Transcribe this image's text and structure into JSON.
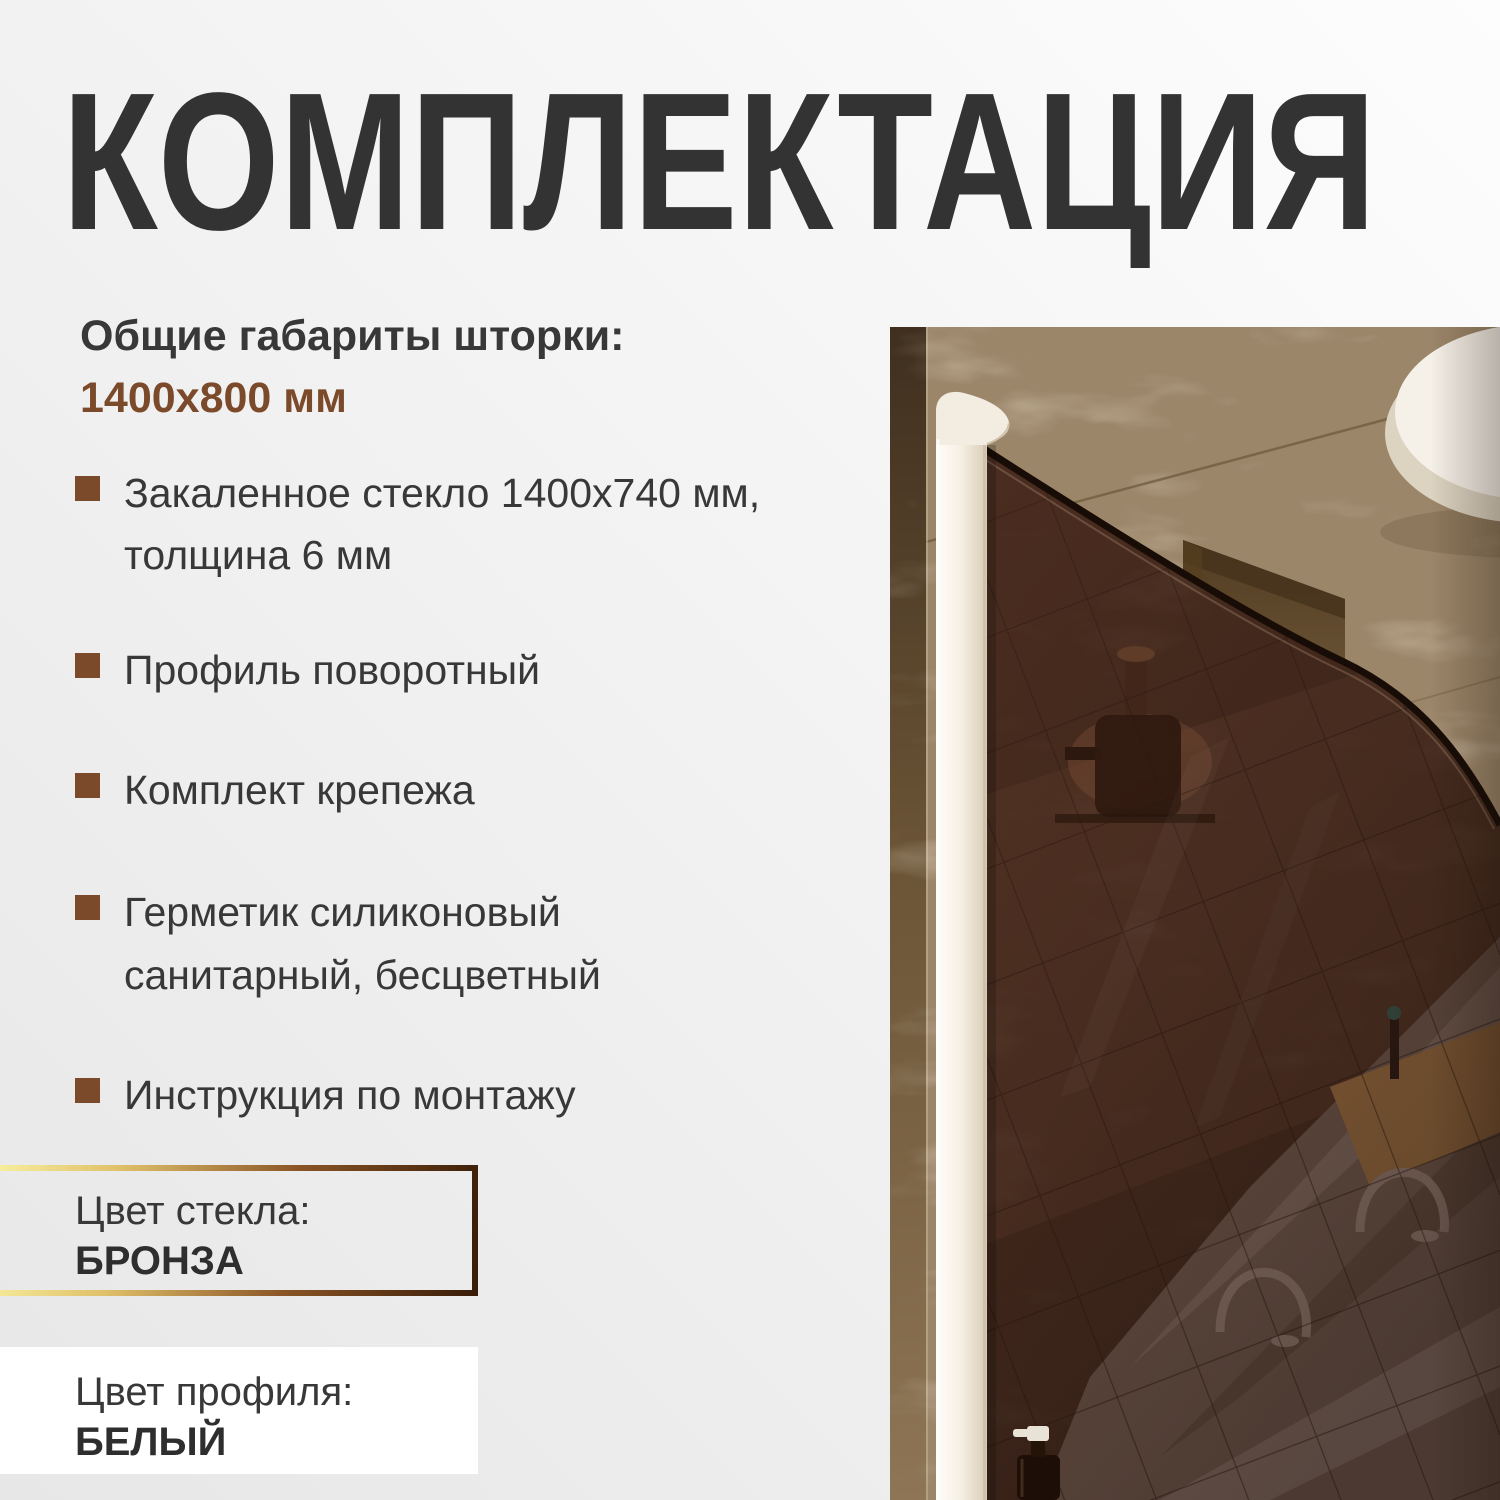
{
  "title": "КОМПЛЕКТАЦИЯ",
  "dimensions": {
    "label": "Общие габариты шторки:",
    "value": "1400х800 мм"
  },
  "features": [
    "Закаленное стекло 1400х740 мм,\nтолщина 6 мм",
    "Профиль поворотный",
    "Комплект крепежа",
    "Герметик силиконовый\nсанитарный, бесцветный",
    "Инструкция по монтажу"
  ],
  "glass_color": {
    "label": "Цвет стекла:",
    "value": "БРОНЗА"
  },
  "profile_color": {
    "label": "Цвет профиля:",
    "value": "БЕЛЫЙ"
  },
  "photo": {
    "alt": "Шторка из бронзового стекла с белым поворотным профилем в ванной с коричневым мрамором"
  },
  "colors": {
    "accent": "#7a4a2b",
    "text_dark": "#383838",
    "text_title": "#333333",
    "gold_start": "#f8f0a0",
    "gold_end": "#3a1d08",
    "glass_bronze": "#4a2f24",
    "profile_white": "#f4efe6",
    "marble_brown": "#9c866a"
  }
}
